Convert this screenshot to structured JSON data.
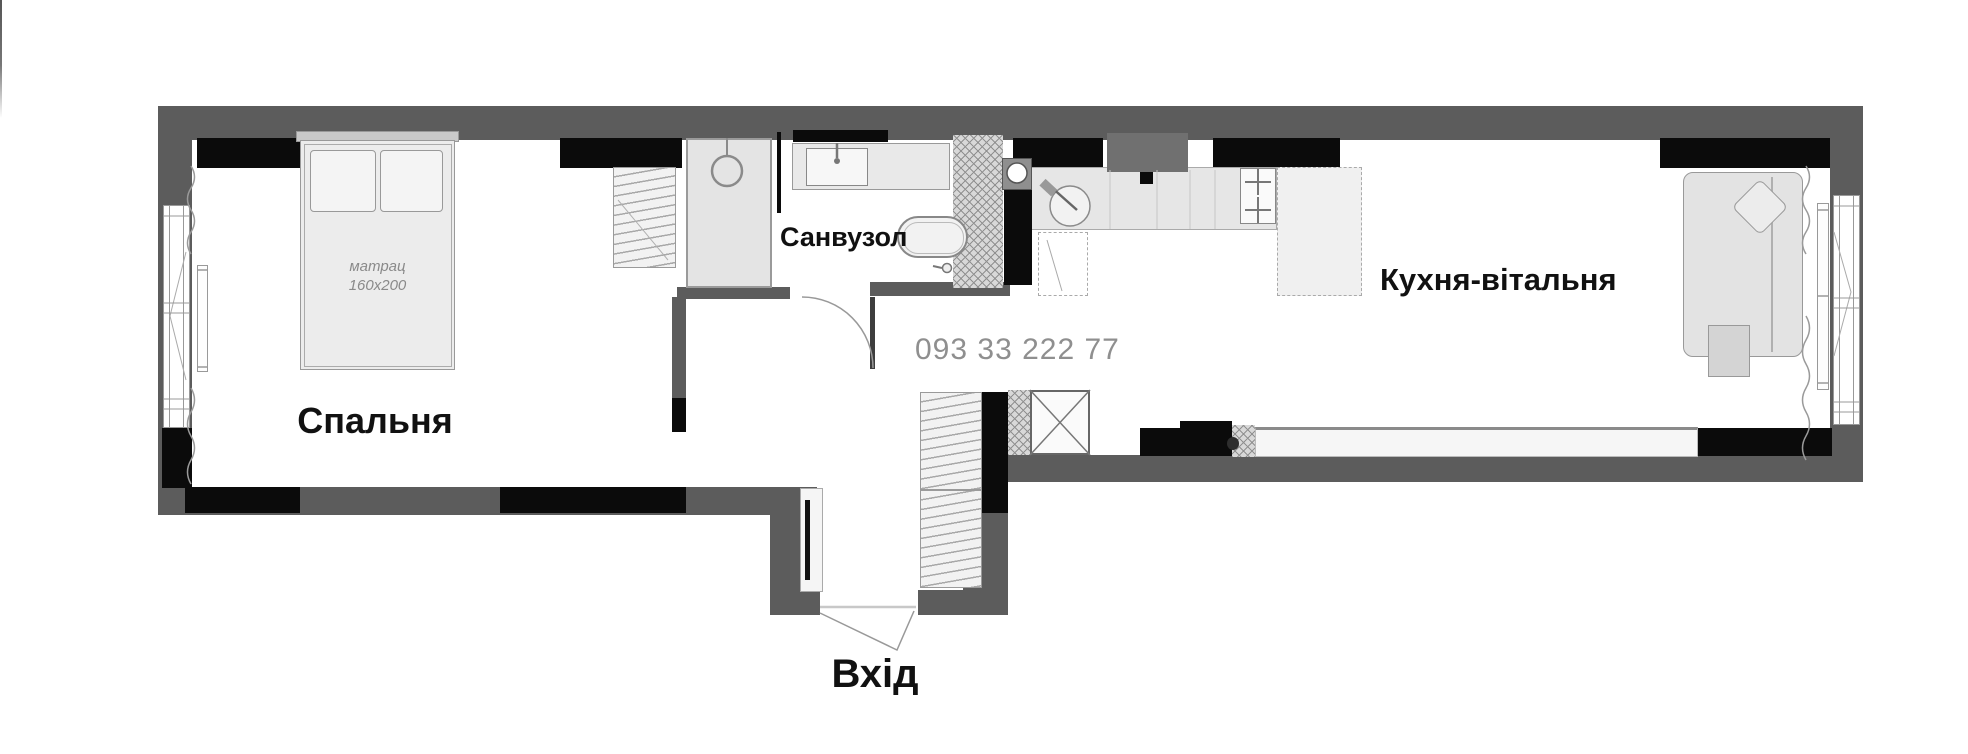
{
  "title": "apartment-floor-plan",
  "labels": {
    "bedroom": "Спальня",
    "bathroom": "Санвузол",
    "kitchen_living": "Кухня-вітальня",
    "entrance": "Вхід"
  },
  "bed": {
    "mattress_line1": "матрац",
    "mattress_line2": "160x200"
  },
  "watermark": {
    "phone": "093 33 222 77"
  },
  "rooms": [
    "Спальня",
    "Санвузол",
    "Кухня-вітальня"
  ],
  "furniture_icons": [
    "double-bed-icon",
    "pillow-icon",
    "wardrobe-icon",
    "shower-icon",
    "vanity-sink-icon",
    "bathtub-icon",
    "toilet-tap-icon",
    "kitchen-sink-icon",
    "stove-icon",
    "boiler-icon",
    "sofa-icon",
    "diamond-pillow-icon",
    "side-table-icon",
    "radiator-icon",
    "mirror-icon",
    "shaft-x-icon",
    "door-arc-icon",
    "entry-door-icon",
    "window-icon",
    "curtain-icon"
  ],
  "colors": {
    "wall_gray": "#5c5c5c",
    "wall_black": "#0b0b0b",
    "duct_gray": "#707070",
    "hatch_line": "#909090",
    "furniture_fill": "#ebebeb",
    "furniture_border": "#999999",
    "label_text": "#111111",
    "watermark_text": "#8f8f8f",
    "floor": "#ffffff"
  }
}
